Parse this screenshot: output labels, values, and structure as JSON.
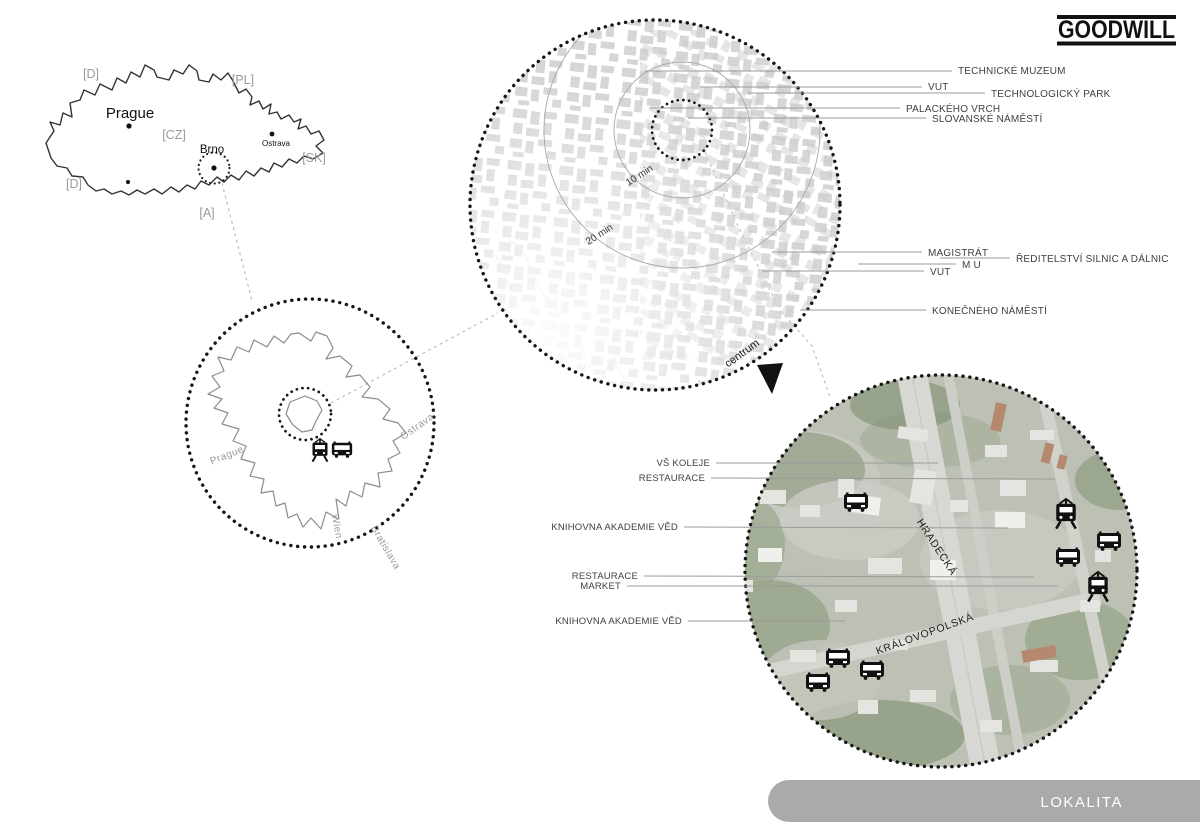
{
  "header": {
    "logo": "GOODWILL"
  },
  "footer": {
    "title": "LOKALITA"
  },
  "country_map": {
    "cities": {
      "prague": "Prague",
      "brno": "Brno",
      "ostrava": "Ostrava"
    },
    "codes": {
      "d_nw": "[D]",
      "pl": "[PL]",
      "cz": "[CZ]",
      "sk": "[SK]",
      "d_sw": "[D]",
      "a": "[A]"
    }
  },
  "city_circle": {
    "directions": {
      "prague": "Prague",
      "ostrava": "Ostrava",
      "wien": "Wien",
      "bratislava": "Bratislava"
    }
  },
  "district_circle": {
    "rings": {
      "r10": "10 min",
      "r20": "20 min"
    },
    "centrum": "centrum",
    "labels": [
      "TECHNICKÉ MUZEUM",
      "VUT",
      "TECHNOLOGICKÝ PARK",
      "PALACKÉHO VRCH",
      "SLOVANSKÉ NÁMĚSTÍ",
      "MAGISTRÁT",
      "ŘEDITELSTVÍ SILNIC A DÁLNIC",
      "M U",
      "VUT",
      "KONEČNÉHO NÁMĚSTÍ"
    ]
  },
  "site_circle": {
    "labels": [
      "VŠ KOLEJE",
      "RESTAURACE",
      "KNIHOVNA AKADEMIE VĚD",
      "RESTAURACE",
      "MARKET",
      "KNIHOVNA AKADEMIE VĚD"
    ],
    "streets": [
      "HRADECKÁ",
      "KRÁLOVOPOLSKÁ"
    ]
  },
  "icons": {
    "tram": "tram-icon",
    "bus": "bus-icon"
  },
  "colors": {
    "page_bg": "#ffffff",
    "footer_bar": "#a8aaac",
    "footer_text": "#ffffff",
    "map_blocks": "#d6d6d6",
    "vegetation": "#96a287",
    "road": "#d6d6d1",
    "icon": "#111111"
  }
}
